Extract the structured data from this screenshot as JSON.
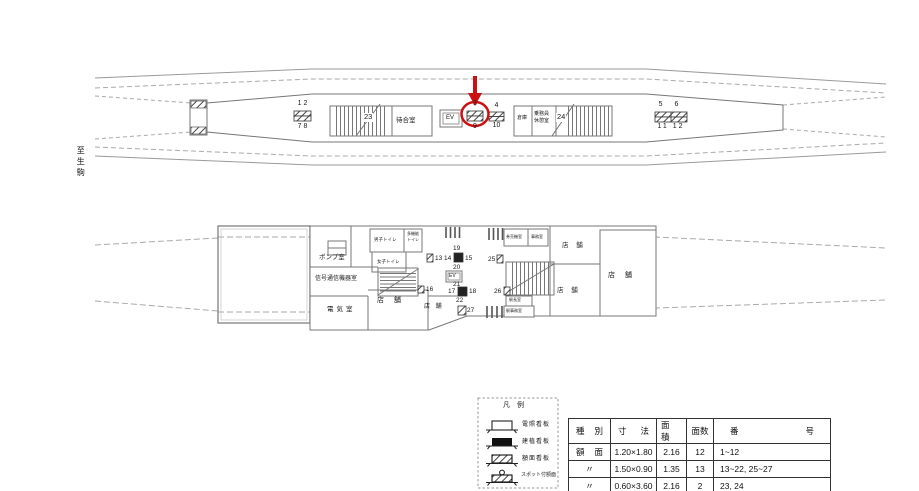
{
  "annotation_color": "#cc1111",
  "direction_label": "至生駒",
  "platform": {
    "signs": {
      "s12_top": "1 2",
      "s12_bottom": "7 8",
      "s39_top": "3",
      "s39_bottom": "9",
      "s39_highlighted": "true",
      "s410_top": "4",
      "s410_bottom": "10",
      "s56_top": "5 6",
      "s56_bottom": "11 12"
    },
    "stair_label_23": "23",
    "stair_label_24": "24",
    "rooms": {
      "waiting": "待合室",
      "elevator": "EV",
      "storage": "倉庫",
      "crew_line1": "乗務員",
      "crew_line2": "休憩室"
    }
  },
  "concourse": {
    "rooms": {
      "pump": "ポンプ室",
      "signal": "信号通信機器室",
      "electric": "電気室",
      "toilet_men": "男子トイレ",
      "toilet_women": "女子トイレ",
      "toilet_multi_line1": "多機能",
      "toilet_multi_line2": "トイレ",
      "elevator": "EV",
      "shop": "店 舗",
      "ticket_machine": "券売機室",
      "office": "事務室",
      "master": "駅長室",
      "station_office": "駅事務室"
    },
    "nums": {
      "n13": "13",
      "n14": "14",
      "n15": "15",
      "n16": "16",
      "n17": "17",
      "n18": "18",
      "n19": "19",
      "n20": "20",
      "n21": "21",
      "n22": "22",
      "n25": "25",
      "n26": "26",
      "n27": "27"
    }
  },
  "legend": {
    "title": "凡　例",
    "items": [
      {
        "label": "電照看板"
      },
      {
        "label": "建植看板"
      },
      {
        "label": "額面看板"
      },
      {
        "label": "スポット付額面"
      }
    ]
  },
  "table": {
    "headers": [
      "種　別",
      "寸　法",
      "面　積",
      "面数",
      "番　　　　号"
    ],
    "rows": [
      [
        "額　面",
        "1.20×1.80",
        "2.16",
        "12",
        "1~12"
      ],
      [
        "〃",
        "1.50×0.90",
        "1.35",
        "13",
        "13~22, 25~27"
      ],
      [
        "〃",
        "0.60×3.60",
        "2.16",
        "2",
        "23, 24"
      ]
    ]
  }
}
